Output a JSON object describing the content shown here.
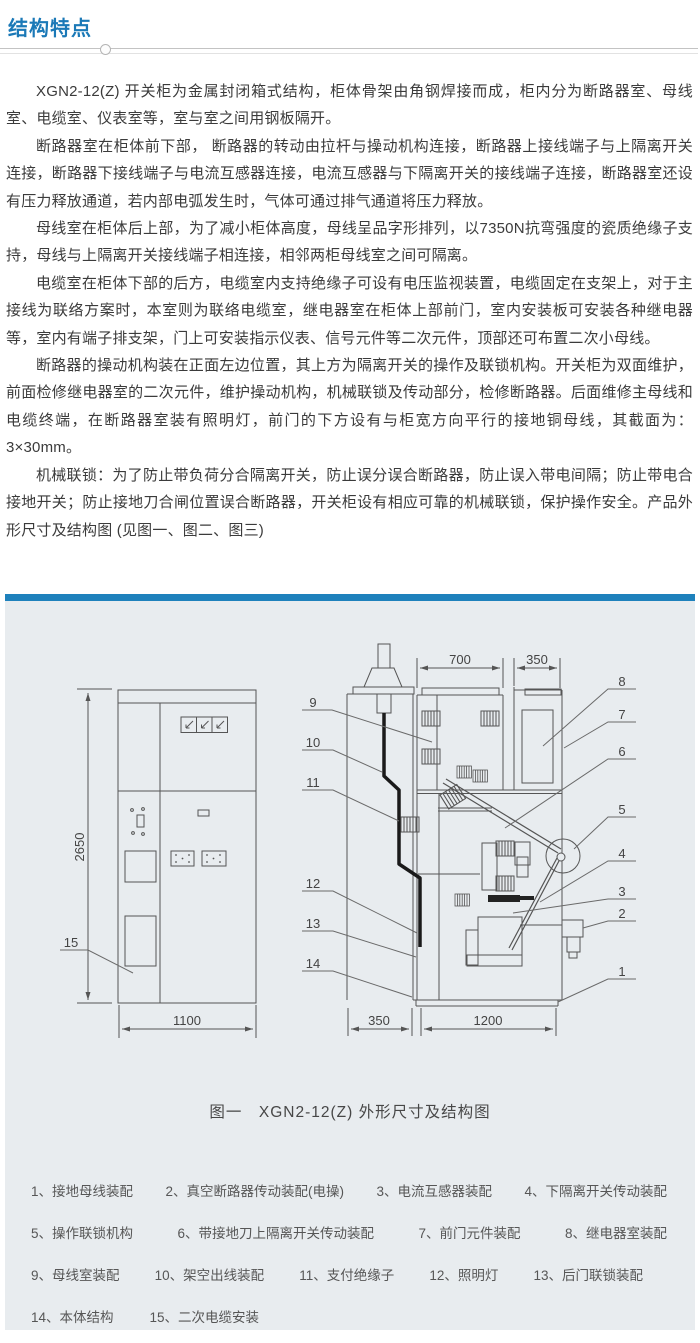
{
  "header": {
    "title": "结构特点"
  },
  "content": {
    "paragraphs": [
      "XGN2-12(Z) 开关柜为金属封闭箱式结构，柜体骨架由角钢焊接而成，柜内分为断路器室、母线室、电缆室、仪表室等，室与室之间用钢板隔开。",
      "断路器室在柜体前下部， 断路器的转动由拉杆与操动机构连接，断路器上接线端子与上隔离开关连接，断路器下接线端子与电流互感器连接，电流互感器与下隔离开关的接线端子连接，断路器室还设有压力释放通道，若内部电弧发生时，气体可通过排气通道将压力释放。",
      "母线室在柜体后上部，为了减小柜体高度，母线呈品字形排列，以7350N抗弯强度的瓷质绝缘子支持，母线与上隔离开关接线端子相连接，相邻两柜母线室之间可隔离。",
      "电缆室在柜体下部的后方，电缆室内支持绝缘子可设有电压监视装置，电缆固定在支架上，对于主接线为联络方案时，本室则为联络电缆室，继电器室在柜体上部前门，室内安装板可安装各种继电器等，室内有端子排支架，门上可安装指示仪表、信号元件等二次元件，顶部还可布置二次小母线。",
      "断路器的操动机构装在正面左边位置，其上方为隔离开关的操作及联锁机构。开关柜为双面维护，前面检修继电器室的二次元件，维护操动机构，机械联锁及传动部分，检修断路器。后面维修主母线和电缆终端，在断路器室装有照明灯，前门的下方设有与柜宽方向平行的接地铜母线，其截面为：3×30mm。",
      "机械联锁：为了防止带负荷分合隔离开关，防止误分误合断路器，防止误入带电间隔；防止带电合接地开关；防止接地刀合闸位置误合断路器，开关柜设有相应可靠的机械联锁，保护操作安全。产品外形尺寸及结构图 (见图一、图二、图三)"
    ]
  },
  "figure": {
    "caption": "图一　XGN2-12(Z) 外形尺寸及结构图",
    "dims": {
      "front_height": "2650",
      "front_width": "1100",
      "top_main_depth": "700",
      "top_relay_depth": "350",
      "bottom_rear_depth": "350",
      "bottom_main_depth": "1200"
    },
    "callouts": [
      "1",
      "2",
      "3",
      "4",
      "5",
      "6",
      "7",
      "8",
      "9",
      "10",
      "11",
      "12",
      "13",
      "14",
      "15"
    ]
  },
  "legend": {
    "rows": [
      {
        "items": [
          "1、接地母线装配",
          "2、真空断路器传动装配(电操)",
          "3、电流互感器装配",
          "4、下隔离开关传动装配"
        ]
      },
      {
        "items": [
          "5、操作联锁机构",
          "6、带接地刀上隔离开关传动装配",
          "7、前门元件装配",
          "8、继电器室装配"
        ]
      },
      {
        "items": [
          "9、母线室装配",
          "10、架空出线装配",
          "11、支付绝缘子",
          "12、照明灯",
          "13、后门联锁装配"
        ]
      },
      {
        "items": [
          "14、本体结构",
          "15、二次电缆安装"
        ]
      }
    ]
  },
  "colors": {
    "accent_blue": "#1b79b7",
    "bar_blue": "#1e81bc",
    "panel_bg": "#e8ecef"
  }
}
